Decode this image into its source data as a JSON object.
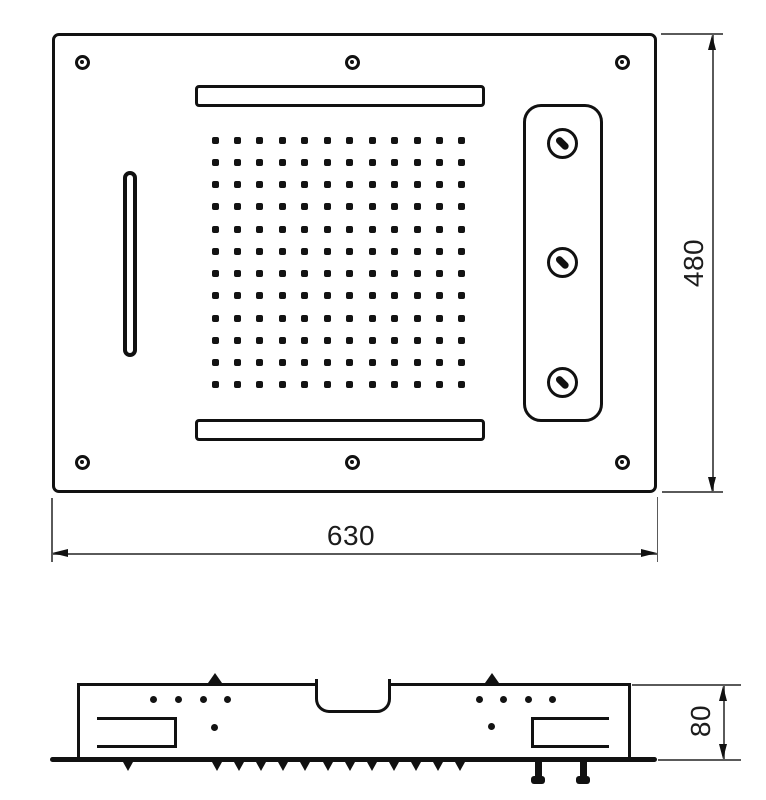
{
  "drawing": {
    "type": "ceiling-shower-head-technical-drawing",
    "dimensions": {
      "width_mm": "630",
      "height_mm": "480",
      "depth_mm": "80"
    },
    "top_view": {
      "nozzle_rows": 12,
      "nozzle_cols": 12,
      "screw_hole_count": 6,
      "jet_count": 3
    },
    "side_view": {
      "teeth_count": 12,
      "inlet_count": 2,
      "mounting_peg_count": 2
    },
    "colors": {
      "line": "#111111",
      "dimension_line": "#5a5a5a",
      "background": "#ffffff"
    }
  }
}
